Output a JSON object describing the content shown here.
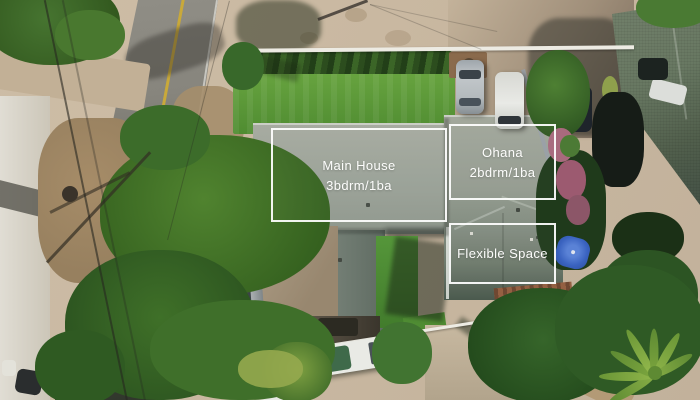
{
  "photo": {
    "description": "Aerial drone view of a residential property with three labeled structures, roads, lawns and trees",
    "labels": {
      "main_house": {
        "title": "Main House",
        "subtitle": "3bdrm/1ba"
      },
      "ohana": {
        "title": "Ohana",
        "subtitle": "2bdrm/1ba"
      },
      "flexible_space": {
        "title": "Flexible Space"
      }
    },
    "colors": {
      "label_border": "#ffffff",
      "label_text": "#ffffff",
      "main_roof_gray": "#9aa096",
      "neighbor_roof_green": "#5f7260",
      "lawn_green": "#5a9739",
      "tree_green": "#3a682a",
      "road_gray": "#82817a",
      "concrete_tan": "#c9b9a3",
      "umbrella_blue": "#3a66c4"
    }
  }
}
